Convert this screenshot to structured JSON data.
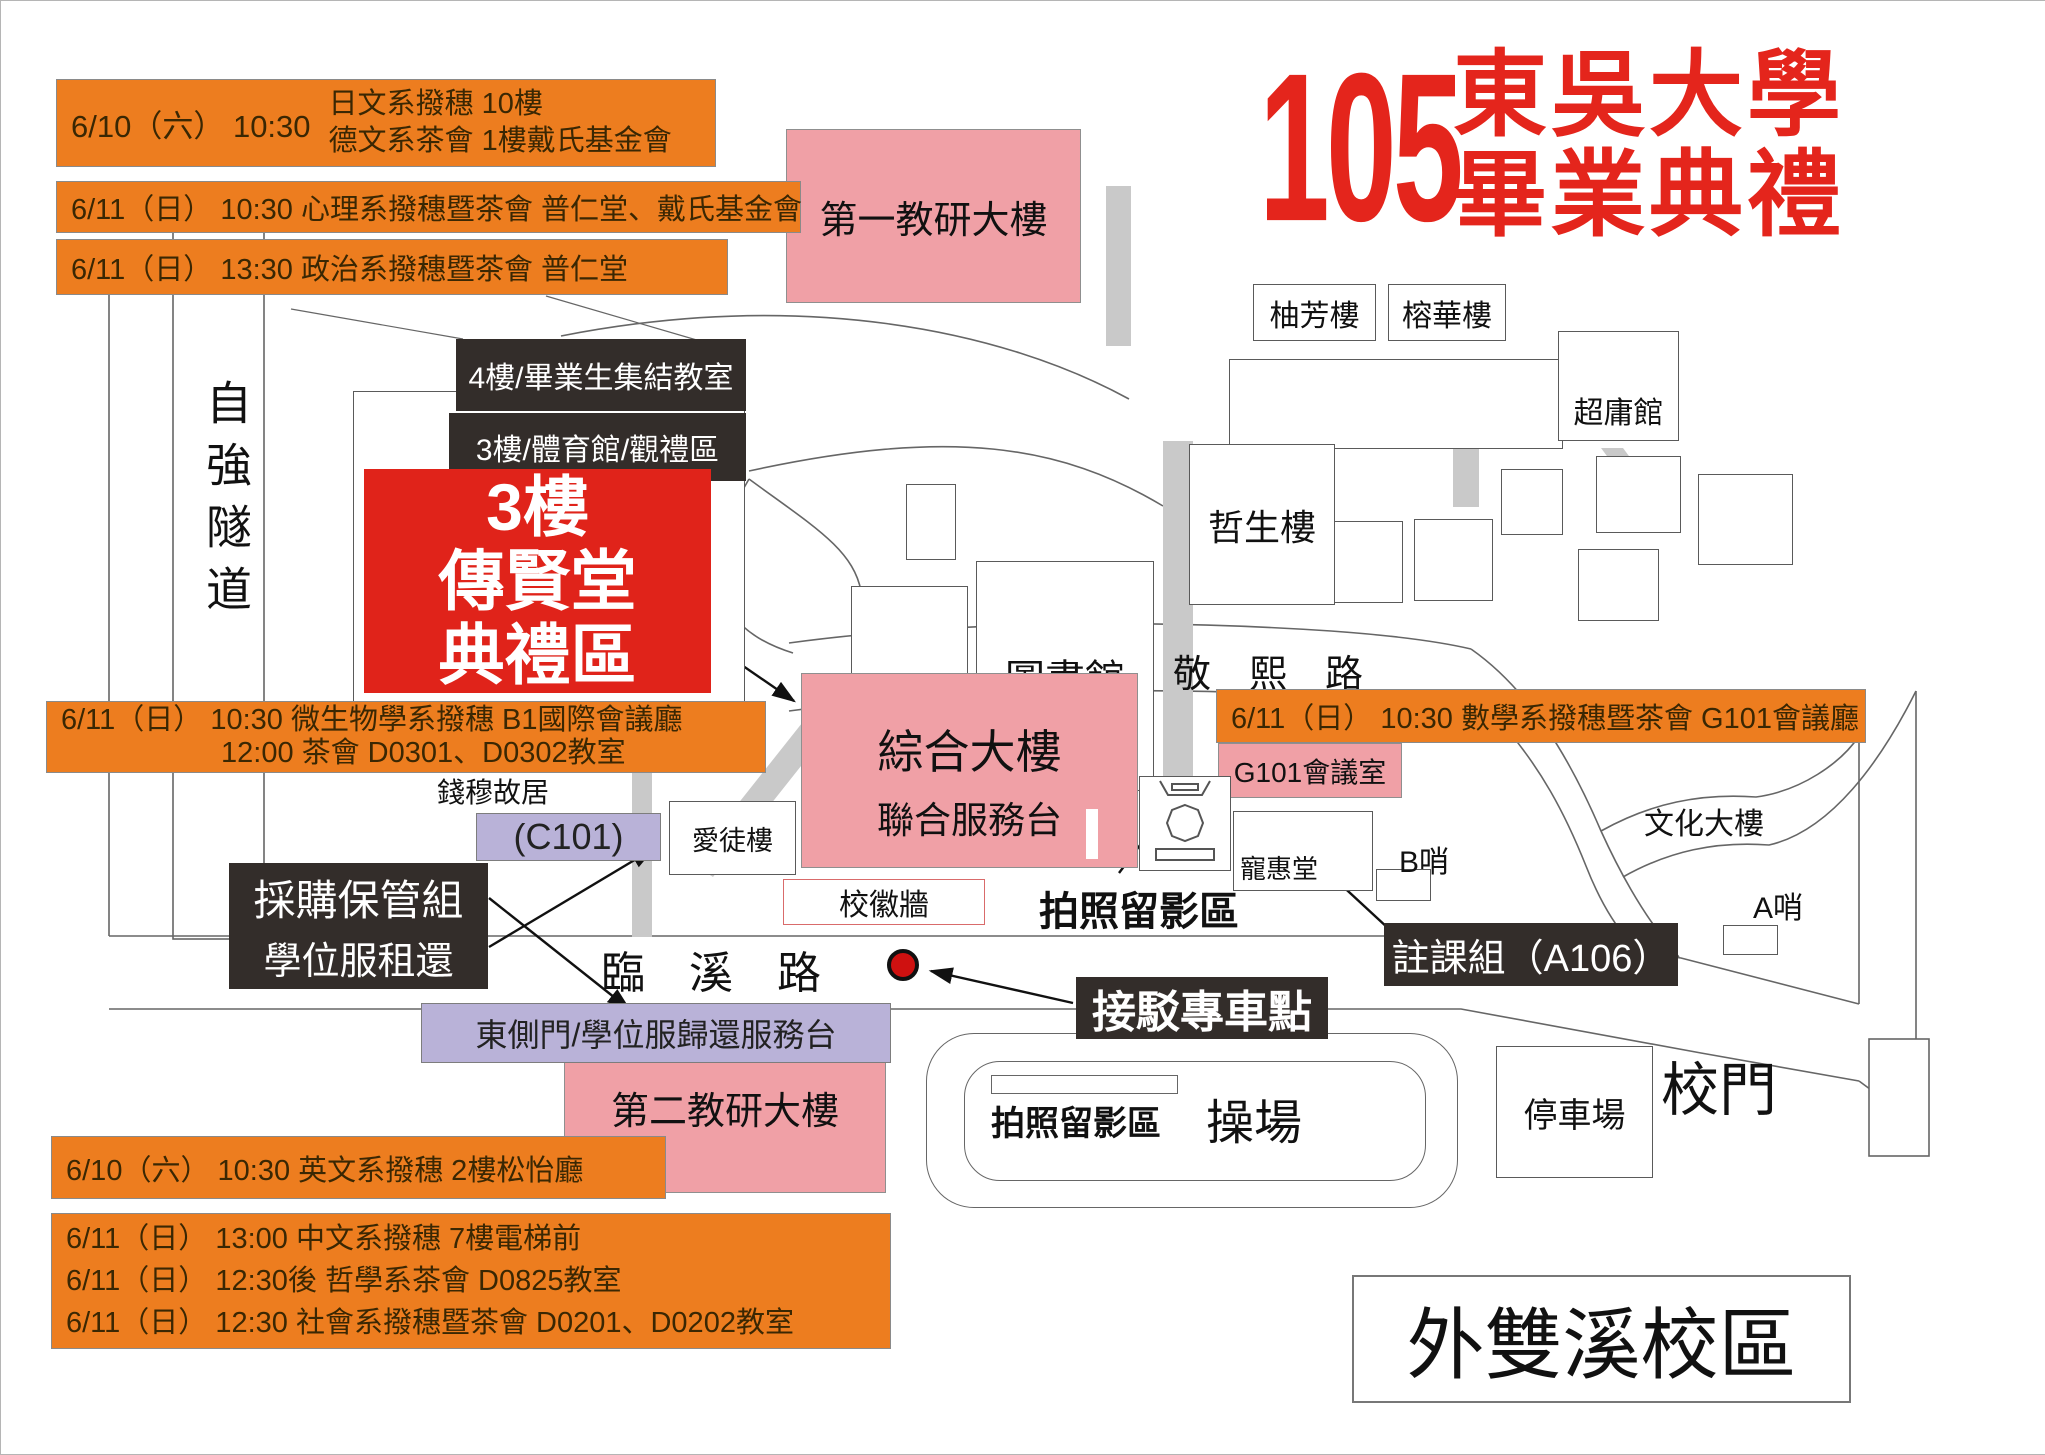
{
  "title": {
    "number": "105",
    "university": "東吳大學",
    "event": "畢業典禮"
  },
  "campus": {
    "name": "外雙溪校區"
  },
  "events": {
    "jp_de": {
      "when": "6/10（六） 10:30",
      "line1": "日文系撥穗 10樓",
      "line2": "德文系茶會 1樓戴氏基金會"
    },
    "psych": "6/11（日） 10:30 心理系撥穗暨茶會 普仁堂、戴氏基金會",
    "politics": "6/11（日） 13:30 政治系撥穗暨茶會 普仁堂",
    "micro_line1": "6/11（日） 10:30 微生物學系撥穗 B1國際會議廳",
    "micro_line2": "12:00 茶會 D0301、D0302教室",
    "math": "6/11（日） 10:30 數學系撥穗暨茶會 G101會議廳",
    "english": "6/10（六） 10:30 英文系撥穗 2樓松怡廳",
    "chinese": "6/11（日） 13:00 中文系撥穗  7樓電梯前",
    "philosophy": "6/11（日） 12:30後 哲學系茶會 D0825教室",
    "sociology": "6/11（日） 12:30 社會系撥穗暨茶會 D0201、D0202教室"
  },
  "callouts": {
    "floor4": "4樓/畢業生集結教室",
    "floor3": "3樓/體育館/觀禮區",
    "hall_line1": "3樓",
    "hall_line2": "傳賢堂",
    "hall_line3": "典禮區",
    "procurement_line1": "採購保管組",
    "procurement_line2": "學位服租還",
    "east_gate": "東側門/學位服歸還服務台",
    "c101": "(C101)",
    "registrar": "註課組（A106）",
    "shuttle": "接駁專車點",
    "photo_statue": "拍照留影區",
    "photo_field": "拍照留影區"
  },
  "buildings": {
    "research1": "第一教研大樓",
    "research2": "第二教研大樓",
    "library": "圖書館",
    "zhesheng": "哲生樓",
    "youfang": "柚芳樓",
    "ronghua": "榕華樓",
    "chaoyong": "超庸館",
    "general_hall": "綜合大樓",
    "service_desk": "聯合服務台",
    "g101_room": "G101會議室",
    "chonghui": "寵惠堂",
    "aitu": "愛徒樓",
    "qianmu": "錢穆故居",
    "badge_wall": "校徽牆",
    "culture": "文化大樓",
    "b_post": "B哨",
    "a_post": "A哨",
    "parking": "停車場",
    "playground": "操場",
    "school_gate": "校門"
  },
  "roads": {
    "ziqiang_tunnel": "自強隧道",
    "linxi_road": "臨　溪　路",
    "jingxi_road": "敬　熙　路"
  },
  "colors": {
    "accent_red": "#e4251c",
    "orange": "#ed7d1f",
    "pink": "#f0a0a6",
    "lavender": "#b9b2d8",
    "dark_box": "#332d2a",
    "road_gray": "#c9c9c9"
  }
}
